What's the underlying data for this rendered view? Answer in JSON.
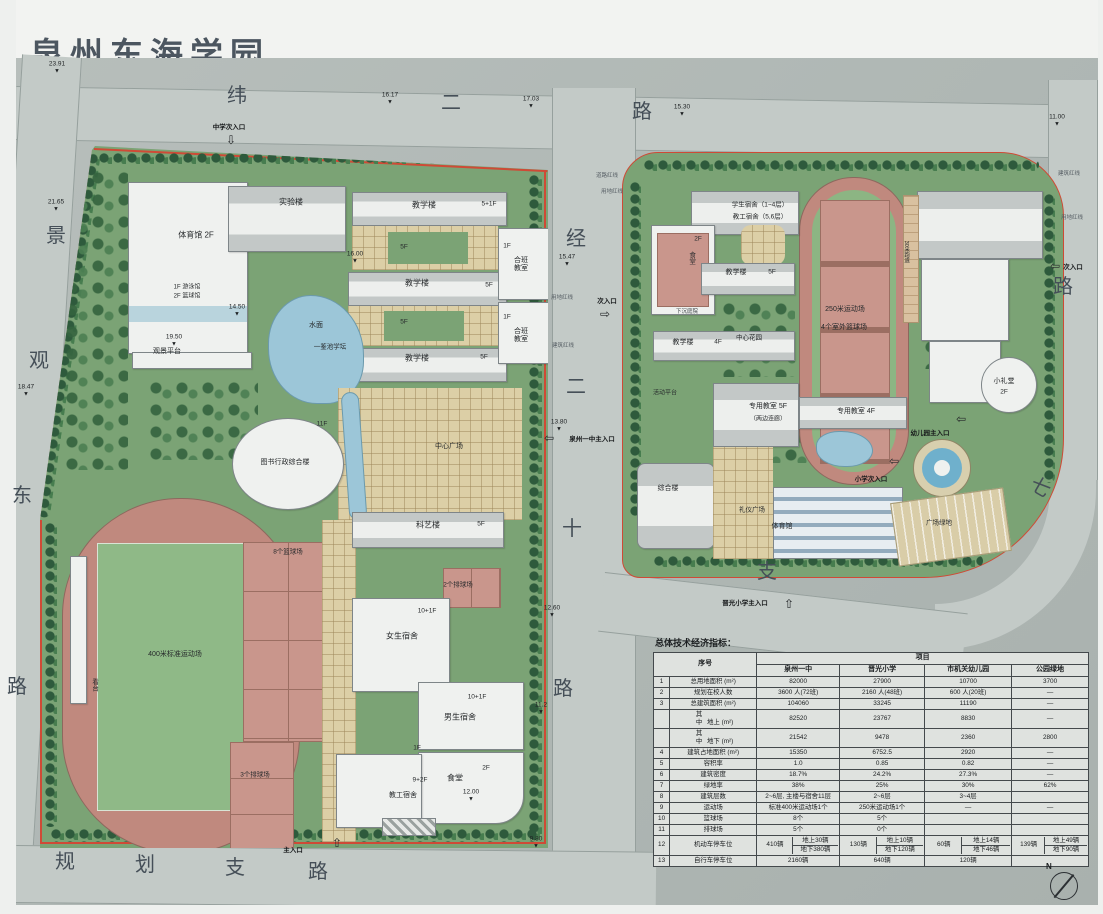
{
  "title": "泉州东海学园",
  "colors": {
    "board": "#b3bab7",
    "road": "#c3cac7",
    "campus_green": "#7ba375",
    "track_pink": "#c0897e",
    "court_pink": "#c9968c",
    "field_green": "#8fb987",
    "water_blue": "#9cc6d8",
    "paving_tan": "#dccfa6",
    "boundary_red": "#cf4a36"
  },
  "plan": {
    "north_label": "N",
    "labels": [
      {
        "t": "纬",
        "x": 237,
        "y": 96,
        "road": 1
      },
      {
        "t": "二",
        "x": 451,
        "y": 103,
        "road": 1
      },
      {
        "t": "路",
        "x": 642,
        "y": 112,
        "road": 1
      },
      {
        "t": "景",
        "x": 56,
        "y": 236,
        "road": 1
      },
      {
        "t": "观",
        "x": 39,
        "y": 361,
        "road": 1
      },
      {
        "t": "东",
        "x": 22,
        "y": 496,
        "road": 1
      },
      {
        "t": "路",
        "x": 17,
        "y": 687,
        "road": 1
      },
      {
        "t": "经",
        "x": 576,
        "y": 239,
        "road": 1
      },
      {
        "t": "二",
        "x": 576,
        "y": 387,
        "road": 1
      },
      {
        "t": "十",
        "x": 572,
        "y": 529,
        "road": 1
      },
      {
        "t": "路",
        "x": 563,
        "y": 689,
        "road": 1
      },
      {
        "t": "规",
        "x": 65,
        "y": 862,
        "road": 1
      },
      {
        "t": "划",
        "x": 145,
        "y": 865,
        "road": 1
      },
      {
        "t": "支",
        "x": 235,
        "y": 868,
        "road": 1
      },
      {
        "t": "路",
        "x": 318,
        "y": 872,
        "road": 1
      },
      {
        "t": "路",
        "x": 1063,
        "y": 287,
        "road": 1
      },
      {
        "t": "七",
        "x": 1040,
        "y": 488,
        "road": 1,
        "r": 30
      },
      {
        "t": "支",
        "x": 767,
        "y": 572,
        "road": 1
      },
      {
        "t": "体育馆 2F",
        "x": 196,
        "y": 236
      },
      {
        "t": "1F 游泳馆",
        "x": 187,
        "y": 288,
        "s": 6
      },
      {
        "t": "2F 篮球馆",
        "x": 187,
        "y": 297,
        "s": 6
      },
      {
        "t": "观景平台",
        "x": 167,
        "y": 352,
        "s": 7
      },
      {
        "t": "实验楼",
        "x": 291,
        "y": 203
      },
      {
        "t": "教学楼",
        "x": 424,
        "y": 206
      },
      {
        "t": "5+1F",
        "x": 489,
        "y": 204,
        "s": 6.5
      },
      {
        "t": "教学楼",
        "x": 417,
        "y": 284
      },
      {
        "t": "5F",
        "x": 489,
        "y": 285,
        "s": 6.5
      },
      {
        "t": "教学楼",
        "x": 417,
        "y": 359
      },
      {
        "t": "5F",
        "x": 484,
        "y": 357,
        "s": 6.5
      },
      {
        "t": "5F",
        "x": 404,
        "y": 247,
        "s": 6.5
      },
      {
        "t": "5F",
        "x": 404,
        "y": 322,
        "s": 6.5
      },
      {
        "t": "1F",
        "x": 507,
        "y": 246,
        "s": 6.5
      },
      {
        "t": "合班教室",
        "x": 521,
        "y": 265,
        "w": 18,
        "s": 7
      },
      {
        "t": "1F",
        "x": 507,
        "y": 317,
        "s": 6.5
      },
      {
        "t": "合班教室",
        "x": 521,
        "y": 336,
        "w": 18,
        "s": 7
      },
      {
        "t": "水面",
        "x": 316,
        "y": 326,
        "s": 7
      },
      {
        "t": "一鉴池学坛",
        "x": 330,
        "y": 347,
        "s": 6.5
      },
      {
        "t": "图书行政综合楼",
        "x": 285,
        "y": 463,
        "s": 7
      },
      {
        "t": "11F",
        "x": 322,
        "y": 424,
        "s": 6.5
      },
      {
        "t": "中心广场",
        "x": 449,
        "y": 447,
        "s": 7
      },
      {
        "t": "科艺楼",
        "x": 428,
        "y": 526
      },
      {
        "t": "5F",
        "x": 481,
        "y": 524,
        "s": 6.5
      },
      {
        "t": "2个排球场",
        "x": 458,
        "y": 585,
        "s": 6.5
      },
      {
        "t": "10+1F",
        "x": 427,
        "y": 611,
        "s": 6.5
      },
      {
        "t": "女生宿舍",
        "x": 402,
        "y": 637
      },
      {
        "t": "10+1F",
        "x": 477,
        "y": 697,
        "s": 6.5
      },
      {
        "t": "男生宿舍",
        "x": 460,
        "y": 718
      },
      {
        "t": "1F",
        "x": 417,
        "y": 748,
        "s": 6.5
      },
      {
        "t": "2F",
        "x": 486,
        "y": 768,
        "s": 6.5
      },
      {
        "t": "食堂",
        "x": 455,
        "y": 779
      },
      {
        "t": "9+2F",
        "x": 420,
        "y": 780,
        "s": 6.5
      },
      {
        "t": "教工宿舍",
        "x": 403,
        "y": 796,
        "s": 7
      },
      {
        "t": "400米标准运动场",
        "x": 175,
        "y": 655,
        "s": 7
      },
      {
        "t": "8个篮球场",
        "x": 288,
        "y": 552,
        "s": 6.5
      },
      {
        "t": "3个排球场",
        "x": 255,
        "y": 775,
        "s": 6.5
      },
      {
        "t": "看台",
        "x": 94,
        "y": 685,
        "v": 1,
        "s": 6.5
      },
      {
        "t": "学生宿舍（1~4层）",
        "x": 760,
        "y": 205,
        "s": 6.5
      },
      {
        "t": "教工宿舍（5,6层）",
        "x": 760,
        "y": 217,
        "s": 6.5
      },
      {
        "t": "2F",
        "x": 698,
        "y": 239,
        "s": 6.5
      },
      {
        "t": "食堂",
        "x": 691,
        "y": 258,
        "v": 1,
        "s": 6.5
      },
      {
        "t": "教学楼",
        "x": 736,
        "y": 273,
        "s": 7
      },
      {
        "t": "5F",
        "x": 772,
        "y": 272,
        "s": 6.5
      },
      {
        "t": "下沉庭院",
        "x": 687,
        "y": 312,
        "s": 5.5,
        "c": "#3c4246"
      },
      {
        "t": "教学楼",
        "x": 683,
        "y": 343,
        "s": 7
      },
      {
        "t": "4F",
        "x": 718,
        "y": 342,
        "s": 6.5
      },
      {
        "t": "中心花园",
        "x": 749,
        "y": 338,
        "s": 6.5
      },
      {
        "t": "250米运动场",
        "x": 845,
        "y": 310,
        "s": 7
      },
      {
        "t": "4个室外篮球场",
        "x": 844,
        "y": 328,
        "s": 7
      },
      {
        "t": "活动平台",
        "x": 665,
        "y": 394,
        "s": 6
      },
      {
        "t": "专用教室 5F",
        "x": 768,
        "y": 407,
        "s": 7
      },
      {
        "t": "（两边连廊）",
        "x": 768,
        "y": 420,
        "s": 6
      },
      {
        "t": "专用教室 4F",
        "x": 856,
        "y": 412,
        "s": 7
      },
      {
        "t": "综合楼",
        "x": 668,
        "y": 489,
        "s": 7
      },
      {
        "t": "礼仪广场",
        "x": 752,
        "y": 510,
        "s": 6.5
      },
      {
        "t": "体育馆",
        "x": 782,
        "y": 527,
        "s": 7
      },
      {
        "t": "小礼堂",
        "x": 1004,
        "y": 382,
        "s": 7
      },
      {
        "t": "2F",
        "x": 1004,
        "y": 392,
        "s": 6.5
      },
      {
        "t": "30米跑道",
        "x": 906,
        "y": 252,
        "v": 1,
        "s": 5.5
      },
      {
        "t": "广场绿地",
        "x": 939,
        "y": 523,
        "s": 6.5
      },
      {
        "t": "道路红线",
        "x": 607,
        "y": 176,
        "s": 5.5,
        "c": "#555d63"
      },
      {
        "t": "用地红线",
        "x": 612,
        "y": 192,
        "s": 5.5,
        "c": "#555d63"
      },
      {
        "t": "用地红线",
        "x": 562,
        "y": 298,
        "s": 5.5,
        "c": "#555d63"
      },
      {
        "t": "建筑红线",
        "x": 563,
        "y": 346,
        "s": 5.5,
        "c": "#555d63"
      },
      {
        "t": "建筑红线",
        "x": 1069,
        "y": 174,
        "s": 5.5,
        "c": "#555d63"
      },
      {
        "t": "用地红线",
        "x": 1072,
        "y": 218,
        "s": 5.5,
        "c": "#555d63"
      }
    ],
    "elevations": [
      {
        "v": "23.91",
        "x": 57,
        "y": 68
      },
      {
        "v": "16.17",
        "x": 390,
        "y": 99
      },
      {
        "v": "17.03",
        "x": 531,
        "y": 103
      },
      {
        "v": "15.30",
        "x": 682,
        "y": 111
      },
      {
        "v": "11.00",
        "x": 1057,
        "y": 121
      },
      {
        "v": "21.65",
        "x": 56,
        "y": 206
      },
      {
        "v": "18.47",
        "x": 26,
        "y": 391
      },
      {
        "v": "15.47",
        "x": 567,
        "y": 261
      },
      {
        "v": "16.00",
        "x": 355,
        "y": 258
      },
      {
        "v": "19.50",
        "x": 174,
        "y": 341
      },
      {
        "v": "14.50",
        "x": 237,
        "y": 311
      },
      {
        "v": "13.80",
        "x": 559,
        "y": 426
      },
      {
        "v": "12.60",
        "x": 552,
        "y": 612
      },
      {
        "v": "12.00",
        "x": 471,
        "y": 796
      },
      {
        "v": "11.2",
        "x": 541,
        "y": 709
      },
      {
        "v": "9.80",
        "x": 536,
        "y": 843
      }
    ],
    "entrances": [
      {
        "t": "中学次入口",
        "x": 229,
        "y": 126,
        "dir": "down",
        "ax": 231,
        "ay": 140
      },
      {
        "t": "次入口",
        "x": 607,
        "y": 300,
        "dir": "right",
        "ax": 605,
        "ay": 314
      },
      {
        "t": "泉州一中主入口",
        "x": 592,
        "y": 438,
        "dir": "left",
        "ax": 549,
        "ay": 438
      },
      {
        "t": "晋光小学主入口",
        "x": 745,
        "y": 602,
        "dir": "up",
        "ax": 789,
        "ay": 604
      },
      {
        "t": "小学次入口",
        "x": 871,
        "y": 478,
        "dir": "left",
        "ax": 894,
        "ay": 461
      },
      {
        "t": "幼儿园主入口",
        "x": 930,
        "y": 432,
        "dir": "left",
        "ax": 961,
        "ay": 419
      },
      {
        "t": "次入口",
        "x": 1073,
        "y": 266,
        "dir": "left",
        "ax": 1055,
        "ay": 266
      },
      {
        "t": "主入口",
        "x": 293,
        "y": 849,
        "dir": "up",
        "ax": 337,
        "ay": 843
      }
    ]
  },
  "table": {
    "title": "总体技术经济指标：",
    "col_index": "序号",
    "col_project": "项目",
    "columns": [
      "泉州一中",
      "晋光小学",
      "市机关幼儿园",
      "公园绿地"
    ],
    "rows": [
      {
        "num": "1",
        "label": "总用地面积 (m²)",
        "cells": [
          "82000",
          "27900",
          "10700",
          "3700"
        ]
      },
      {
        "num": "2",
        "label": "规划在校人数",
        "cells": [
          "3600 人(72班)",
          "2160 人(48班)",
          "600 人(20班)",
          "—"
        ]
      },
      {
        "num": "3",
        "label": "总建筑面积 (m²)",
        "cells": [
          "104060",
          "33245",
          "11190",
          "—"
        ]
      },
      {
        "num": "",
        "sub": "其中",
        "label": "地上 (m²)",
        "cells": [
          "82520",
          "23767",
          "8830",
          "—"
        ]
      },
      {
        "num": "",
        "sub": "其中",
        "label": "地下 (m²)",
        "cells": [
          "21542",
          "9478",
          "2360",
          "2800"
        ]
      },
      {
        "num": "4",
        "label": "建筑占地面积 (m²)",
        "cells": [
          "15350",
          "6752.5",
          "2920",
          "—"
        ]
      },
      {
        "num": "5",
        "label": "容积率",
        "cells": [
          "1.0",
          "0.85",
          "0.82",
          "—"
        ]
      },
      {
        "num": "6",
        "label": "建筑密度",
        "cells": [
          "18.7%",
          "24.2%",
          "27.3%",
          "—"
        ]
      },
      {
        "num": "7",
        "label": "绿地率",
        "cells": [
          "38%",
          "25%",
          "30%",
          "62%"
        ]
      },
      {
        "num": "8",
        "label": "建筑层数",
        "cells": [
          "2~6层, 主楼与宿舍11层",
          "2~6层",
          "3~4层",
          ""
        ]
      },
      {
        "num": "9",
        "label": "运动场",
        "cells": [
          "标准400米运动场1个",
          "250米运动场1个",
          "—",
          "—"
        ]
      },
      {
        "num": "10",
        "label": "篮球场",
        "cells": [
          "8个",
          "5个",
          "",
          ""
        ]
      },
      {
        "num": "11",
        "label": "排球场",
        "cells": [
          "5个",
          "0个",
          "",
          ""
        ]
      },
      {
        "num": "12",
        "label": "机动车停车位",
        "cells": [
          {
            "total": "410辆",
            "above": "地上30辆",
            "below": "地下380辆"
          },
          {
            "total": "130辆",
            "above": "地上10辆",
            "below": "地下120辆"
          },
          {
            "total": "60辆",
            "above": "地上14辆",
            "below": "地下46辆"
          },
          {
            "total": "139辆",
            "above": "地上49辆",
            "below": "地下90辆"
          }
        ]
      },
      {
        "num": "13",
        "label": "自行车停车位",
        "cells": [
          "2160辆",
          "640辆",
          "120辆",
          ""
        ]
      }
    ]
  }
}
